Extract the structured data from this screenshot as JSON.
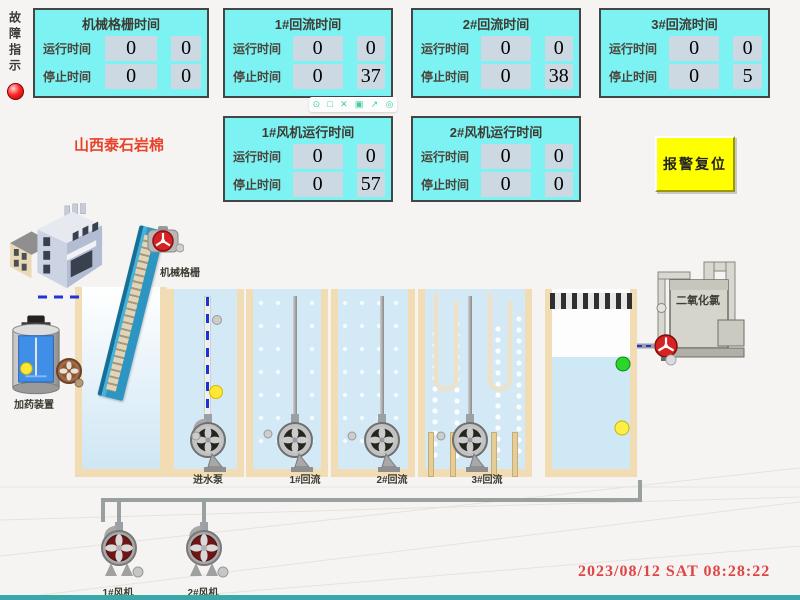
{
  "fault_indicator": {
    "label": "故障指示"
  },
  "company_label": "山西泰石岩棉",
  "alarm_reset": {
    "label": "报警复位"
  },
  "datetime": "2023/08/12  SAT  08:28:22",
  "panels": [
    {
      "title": "机械格栅时间",
      "rows": [
        {
          "label": "运行时间",
          "v1": "0",
          "v2": "0"
        },
        {
          "label": "停止时间",
          "v1": "0",
          "v2": "0"
        }
      ]
    },
    {
      "title": "1#回流时间",
      "rows": [
        {
          "label": "运行时间",
          "v1": "0",
          "v2": "0"
        },
        {
          "label": "停止时间",
          "v1": "0",
          "v2": "37"
        }
      ]
    },
    {
      "title": "2#回流时间",
      "rows": [
        {
          "label": "运行时间",
          "v1": "0",
          "v2": "0"
        },
        {
          "label": "停止时间",
          "v1": "0",
          "v2": "38"
        }
      ]
    },
    {
      "title": "3#回流时间",
      "rows": [
        {
          "label": "运行时间",
          "v1": "0",
          "v2": "0"
        },
        {
          "label": "停止时间",
          "v1": "0",
          "v2": "5"
        }
      ]
    },
    {
      "title": "1#风机运行时间",
      "rows": [
        {
          "label": "运行时间",
          "v1": "0",
          "v2": "0"
        },
        {
          "label": "停止时间",
          "v1": "0",
          "v2": "57"
        }
      ]
    },
    {
      "title": "2#风机运行时间",
      "rows": [
        {
          "label": "运行时间",
          "v1": "0",
          "v2": "0"
        },
        {
          "label": "停止时间",
          "v1": "0",
          "v2": "0"
        }
      ]
    }
  ],
  "toolbar": {
    "icons": [
      {
        "name": "zoom",
        "glyph": "⊙"
      },
      {
        "name": "window",
        "glyph": "□"
      },
      {
        "name": "close",
        "glyph": "✕"
      },
      {
        "name": "grid",
        "glyph": "▣"
      },
      {
        "name": "export",
        "glyph": "↗"
      },
      {
        "name": "settings",
        "glyph": "◎"
      }
    ]
  },
  "diagram": {
    "labels": {
      "screen_machine": "机械格栅",
      "dosing_device": "加药装置",
      "inlet_pump": "进水泵",
      "reflux_1": "1#回流",
      "reflux_2": "2#回流",
      "reflux_3": "3#回流",
      "chlorine_dioxide": "二氧化氯",
      "fan_1": "1#风机",
      "fan_2": "2#风机"
    }
  },
  "colors": {
    "panel_bg": "#7df2f2",
    "panel_border": "#454545",
    "value_cell_bg": "#cdd9e2",
    "alarm_button_bg": "#ffff00",
    "company_text_red": "#e8432a",
    "datetime_red": "#e04545",
    "fault_lamp_red": "#ff2a2a",
    "water_blue": "#d3eaf6",
    "tank_wall_tan": "#f2dcb3",
    "toolbar_icon_green": "#3ecf9a",
    "bottom_strip_teal": "#3aa8a8"
  }
}
